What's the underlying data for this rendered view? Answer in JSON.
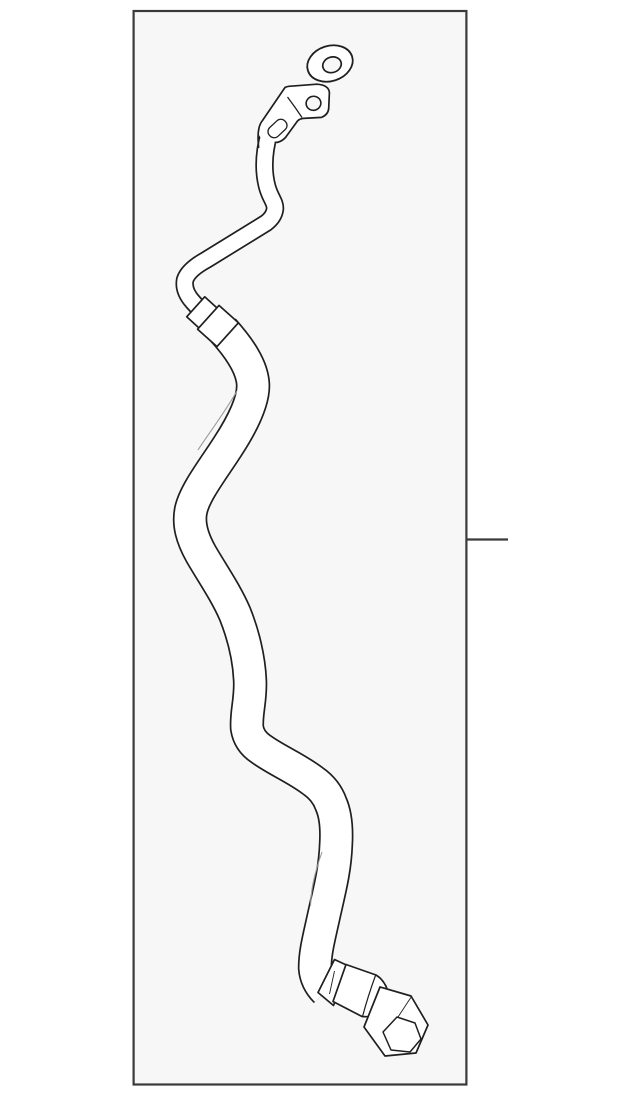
{
  "page": {
    "background_color": "#ffffff"
  },
  "figure": {
    "kind": "auto-part-line-illustration",
    "frame": {
      "background_color": "#f7f7f7",
      "border_color": "#3a3a3a"
    },
    "artwork": {
      "line_color": "#1f1f1f",
      "fill_color": "#ffffff",
      "highlight_color": "#9a9a9a"
    },
    "callout": {
      "side": "right",
      "style": "plain-leader-line"
    },
    "parts": [
      {
        "id": "sealing-washer"
      },
      {
        "id": "mounting-flange"
      },
      {
        "id": "metal-pipe"
      },
      {
        "id": "coupler-fitting"
      },
      {
        "id": "flexible-hose"
      },
      {
        "id": "crimp-ferrule"
      },
      {
        "id": "hex-nut-fitting"
      }
    ]
  }
}
